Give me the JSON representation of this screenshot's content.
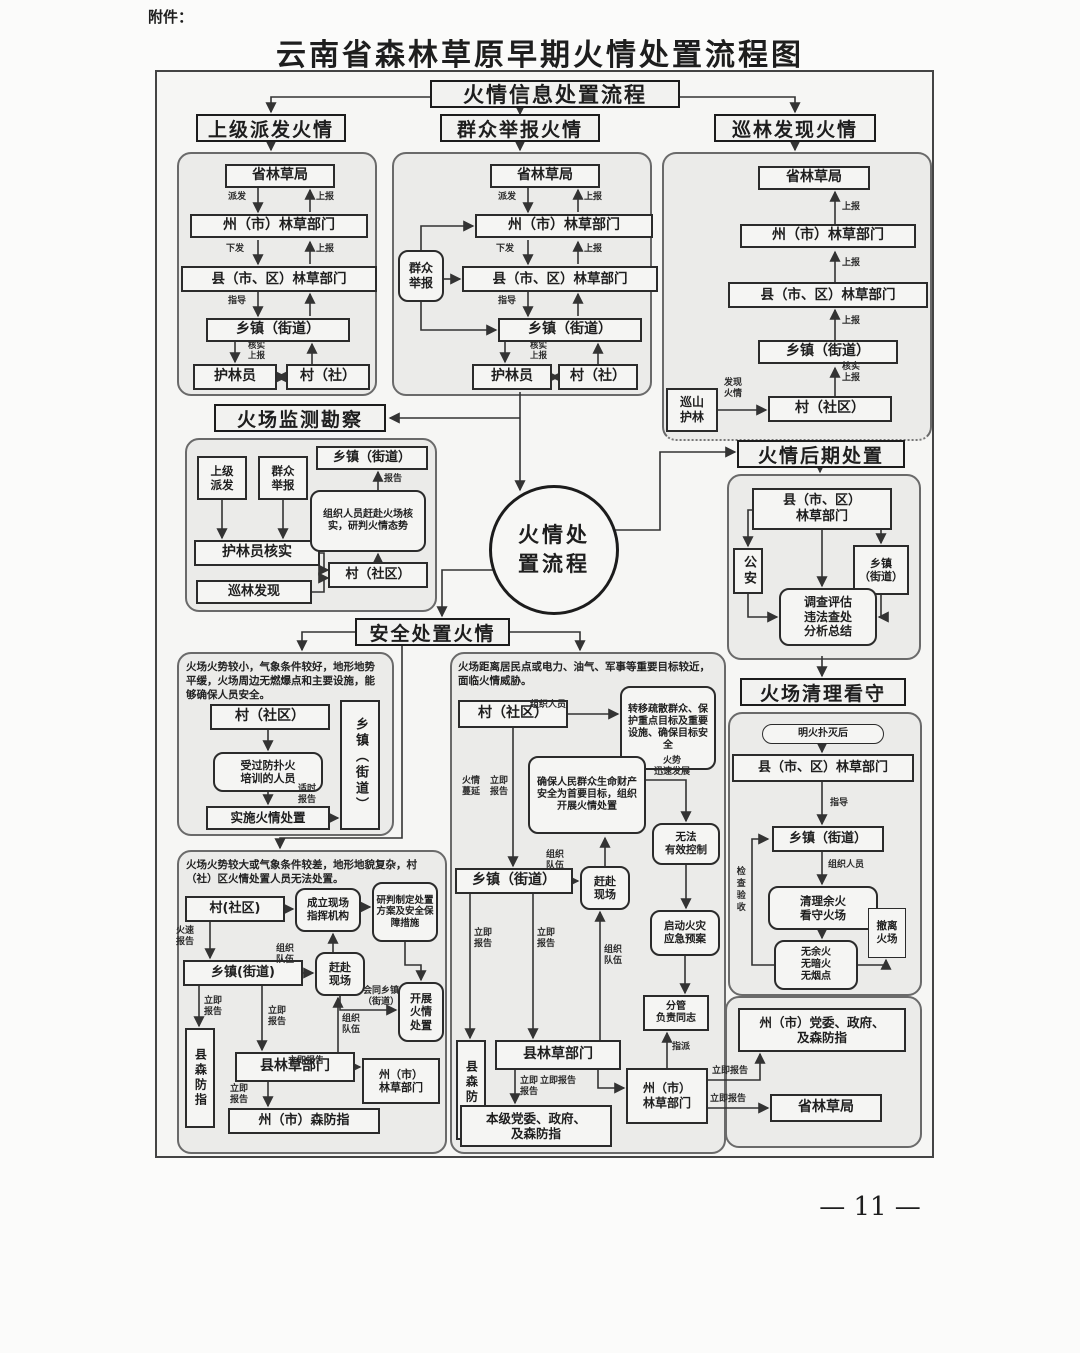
{
  "page": {
    "attachment": "附件：",
    "title": "云南省森林草原早期火情处置流程图",
    "page_number": "— 11 —"
  },
  "headers": {
    "info": "火情信息处置流程",
    "dispatch": "上级派发火情",
    "report": "群众举报火情",
    "patrol": "巡林发现火情",
    "monitor": "火场监测勘察",
    "post": "火情后期处置",
    "safety": "安全处置火情",
    "cleanup": "火场清理看守"
  },
  "circle": {
    "text": "火情处\n置流程"
  },
  "labels": {
    "paifa": "派发",
    "shangbao": "上报",
    "xiafa": "下发",
    "zhidao": "指导",
    "heshi": "核实",
    "baogao": "报告",
    "faxian": "发现\n火情",
    "heshi_shangbao": "核实\n上报",
    "shishi": "适时\n报告",
    "huosu": "火速\n报告",
    "liji": "立即\n报告",
    "liji_h": "立即报告",
    "zuzhi_duiwu": "组织\n队伍",
    "zuzhi_renyuan": "组织人员",
    "manyan": "火情\n蔓延",
    "huoshi": "火势\n迅速发展",
    "huitong": "会同乡镇\n（街道）",
    "zhipai": "指派",
    "jiancha": "检查验收"
  },
  "p1": {
    "prov": "省林草局",
    "state": "州（市）林草部门",
    "county": "县（市、区）林草部门",
    "town": "乡镇（街道）",
    "ranger": "护林员",
    "village": "村（社）"
  },
  "p2": {
    "informant": "群众\n举报",
    "prov": "省林草局",
    "state": "州（市）林草部门",
    "county": "县（市、区）林草部门",
    "town": "乡镇（街道）",
    "ranger": "护林员",
    "village": "村（社）"
  },
  "p3": {
    "prov": "省林草局",
    "state": "州（市）林草部门",
    "county": "县（市、区）林草部门",
    "town": "乡镇（街道）",
    "village": "村（社区）",
    "patrol": "巡山\n护林"
  },
  "p4": {
    "upper": "上级\n派发",
    "mass": "群众\n举报",
    "verify": "护林员核实",
    "found": "巡林发现",
    "organize": "组织人员赶赴火场核实，研判火情态势",
    "town": "乡镇（街道）",
    "village": "村（社区）"
  },
  "p5": {
    "county": "县（市、区）\n林草部门",
    "police": "公安",
    "town": "乡镇\n（街道）",
    "invest": "调查评估\n违法查处\n分析总结"
  },
  "p6": {
    "cond": "火场火势较小，气象条件较好，地形地势平缓，火场周边无燃爆点和主要设施，能够确保人员安全。",
    "village": "村（社区）",
    "trained": "受过防扑火\n培训的人员",
    "dispose": "实施火情处置",
    "town": "乡镇（街道）"
  },
  "p7": {
    "cond": "火场火势较大或气象条件较差，地形地貌复杂，村（社）区火情处置人员无法处置。",
    "village": "村(社区)",
    "command": "成立现场\n指挥机构",
    "plan": "研判制定处置方案及安全保障措施",
    "town": "乡镇(街道)",
    "rush": "赶赴\n现场",
    "carry": "开展\n火情\n处置",
    "cfireprev": "县森防指",
    "ccounty": "县林草部门",
    "sfireprev": "州（市）森防指",
    "sstate": "州（市）\n林草部门"
  },
  "p8": {
    "cond": "火场距离居民点或电力、油气、军事等重要目标较近，面临火情威胁。",
    "village": "村（社区）",
    "evacuate": "转移疏散群众、保护重点目标及重要设施、确保目标安全",
    "ensure": "确保人民群众生命财产安全为首要目标，组织开展火情处置",
    "uncontrol": "无法\n有效控制",
    "launch": "启动火灾\n应急预案",
    "town": "乡镇（街道）",
    "rush": "赶赴\n现场",
    "leader": "分管\n负责同志",
    "cfireprev": "县森防指",
    "ccounty": "县林草部门",
    "party": "本级党委、政府、\n及森防指",
    "sstate": "州（市）\n林草部门"
  },
  "p9": {
    "after": "明火扑灭后",
    "county": "县（市、区）林草部门",
    "town": "乡镇（街道）",
    "clear": "清理余火\n看守火场",
    "none": "无余火\n无暗火\n无烟点",
    "leave": "撤离\n火场"
  },
  "p10": {
    "party": "州（市）党委、政府、\n及森防指",
    "prov": "省林草局"
  }
}
